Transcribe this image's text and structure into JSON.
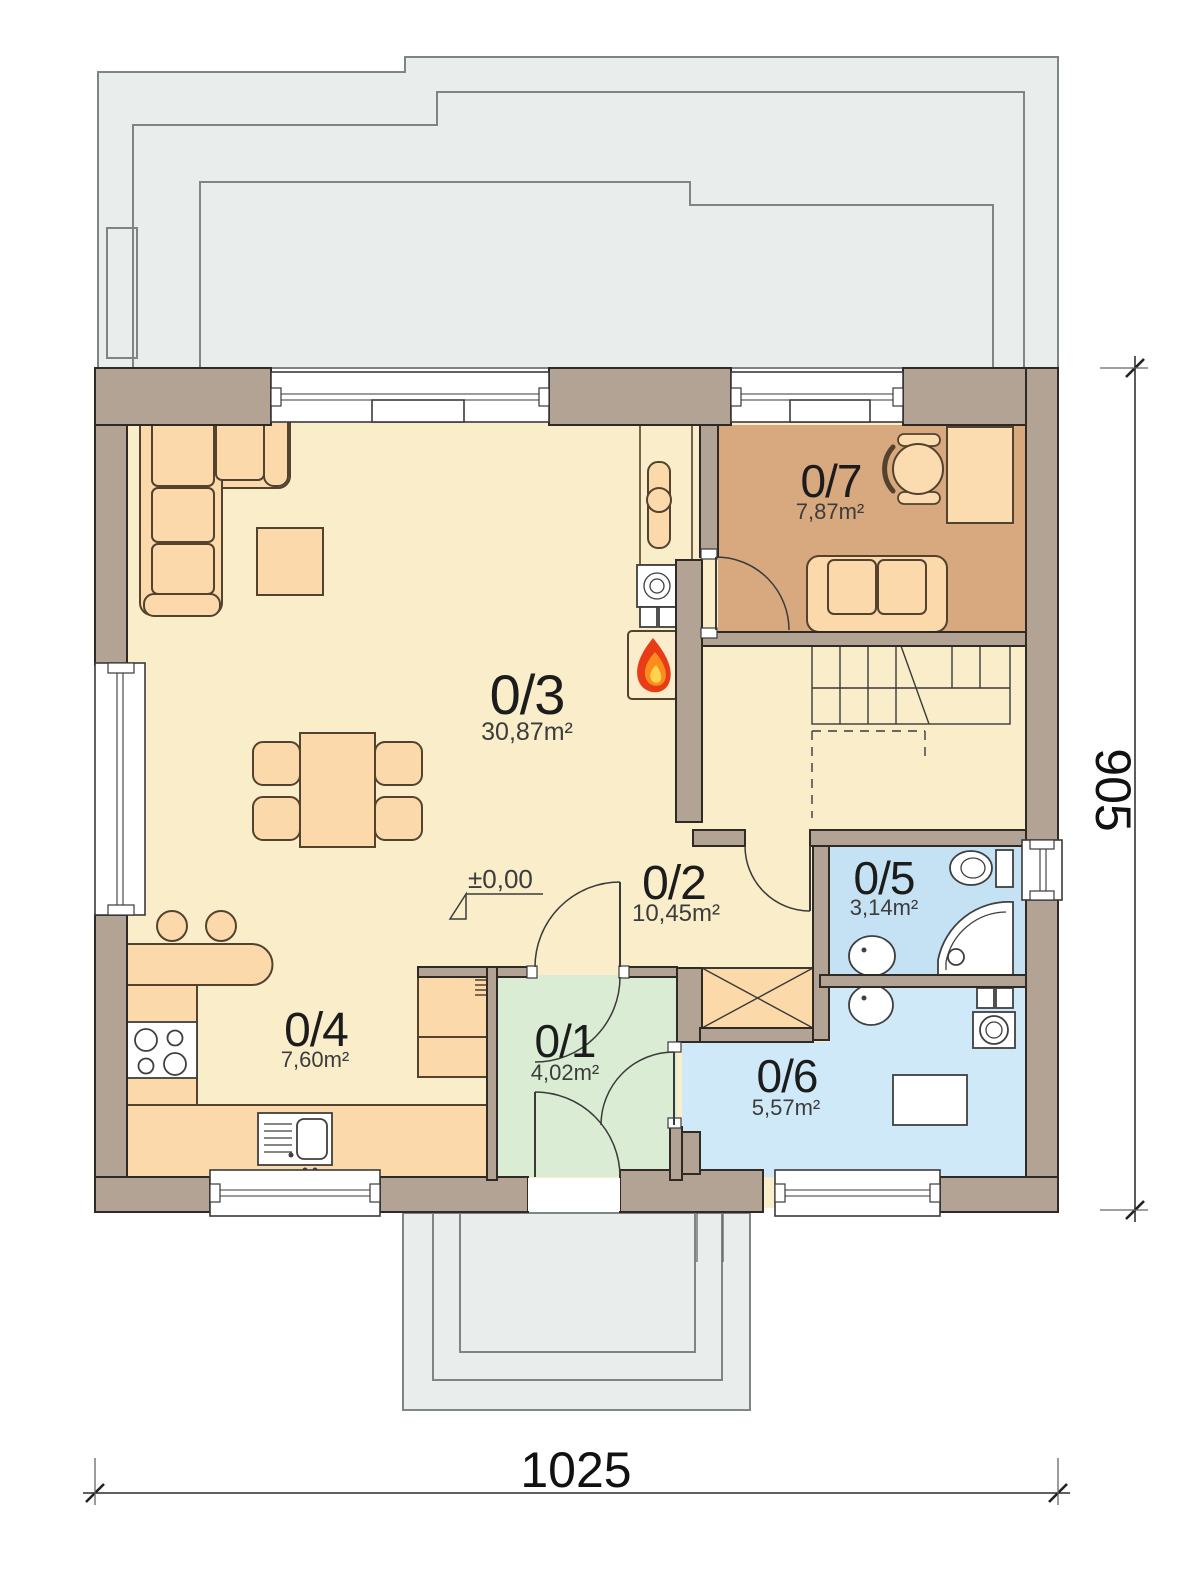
{
  "plan": {
    "rooms": [
      {
        "number": "0/1",
        "area": "4,02m²"
      },
      {
        "number": "0/2",
        "area": "10,45m²"
      },
      {
        "number": "0/3",
        "area": "30,87m²"
      },
      {
        "number": "0/4",
        "area": "7,60m²"
      },
      {
        "number": "0/5",
        "area": "3,14m²"
      },
      {
        "number": "0/6",
        "area": "5,57m²"
      },
      {
        "number": "0/7",
        "area": "7,87m²"
      }
    ],
    "level_marker": "±0,00",
    "dimensions": {
      "width": "1025",
      "height": "905"
    },
    "colors": {
      "wall": "#b2a394",
      "floor_main": "#f9edca",
      "floor_office": "#d8a87e",
      "floor_bath": "#c4e2f3",
      "floor_utility": "#cfe9f8",
      "floor_entry": "#daecd3",
      "furniture": "#fcd9ab",
      "wardrobe": "#fbd9a8",
      "terrace": "#e9edec",
      "flame_outer": "#e83c17",
      "flame_mid": "#fb8c1e",
      "flame_inner": "#ffd34d"
    }
  }
}
